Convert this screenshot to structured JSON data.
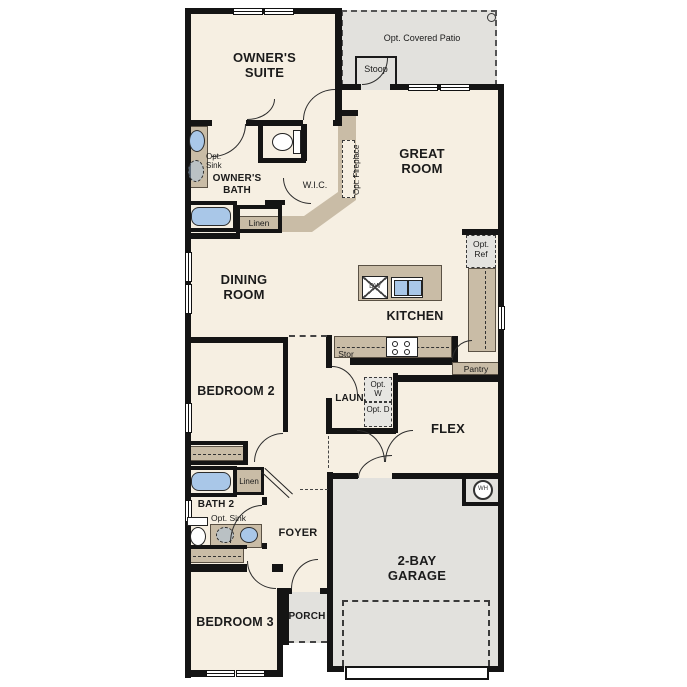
{
  "plan_type": "single-story floor plan",
  "colors": {
    "floor": "#f6efe2",
    "outdoor_concrete": "#e2e1dd",
    "cabinet_wall": "#c9bca6",
    "structural_wall": "#141414",
    "plumbing_fixture_blue": "#a9c7e8",
    "background": "#ffffff"
  },
  "labels": {
    "owners_suite": "OWNER'S SUITE",
    "opt_covered_patio": "Opt. Covered Patio",
    "stoop": "Stoop",
    "great_room": "GREAT ROOM",
    "opt_sink": "Opt. Sink",
    "owners_bath": "OWNER'S BATH",
    "wic": "W.I.C.",
    "opt_fireplace": "Opt. Fireplace",
    "linen": "Linen",
    "dining_room": "DINING ROOM",
    "kitchen": "KITCHEN",
    "opt_ref": "Opt. Ref",
    "pantry": "Pantry",
    "stor": "Stor",
    "laundry": "LAUN.",
    "opt_washer": "Opt. W",
    "opt_dryer": "Opt. D",
    "flex": "FLEX",
    "bedroom_2": "BEDROOM 2",
    "bath_2": "BATH 2",
    "foyer": "FOYER",
    "bedroom_3": "BEDROOM 3",
    "porch": "PORCH",
    "garage": "2-BAY GARAGE",
    "dishwasher": "DW",
    "water_heater": "WH"
  },
  "fixtures": [
    "bathtub-owners",
    "bathtub-bath2",
    "toilet-owners",
    "toilet-bath2",
    "sink-owners-bath",
    "opt-sink-owners-bath",
    "vanity-sink-bath2",
    "opt-sink-bath2",
    "kitchen-island-double-sink",
    "dishwasher",
    "range-stove",
    "washer-opt",
    "dryer-opt",
    "water-heater",
    "garage-door-outline",
    "patio-column"
  ]
}
